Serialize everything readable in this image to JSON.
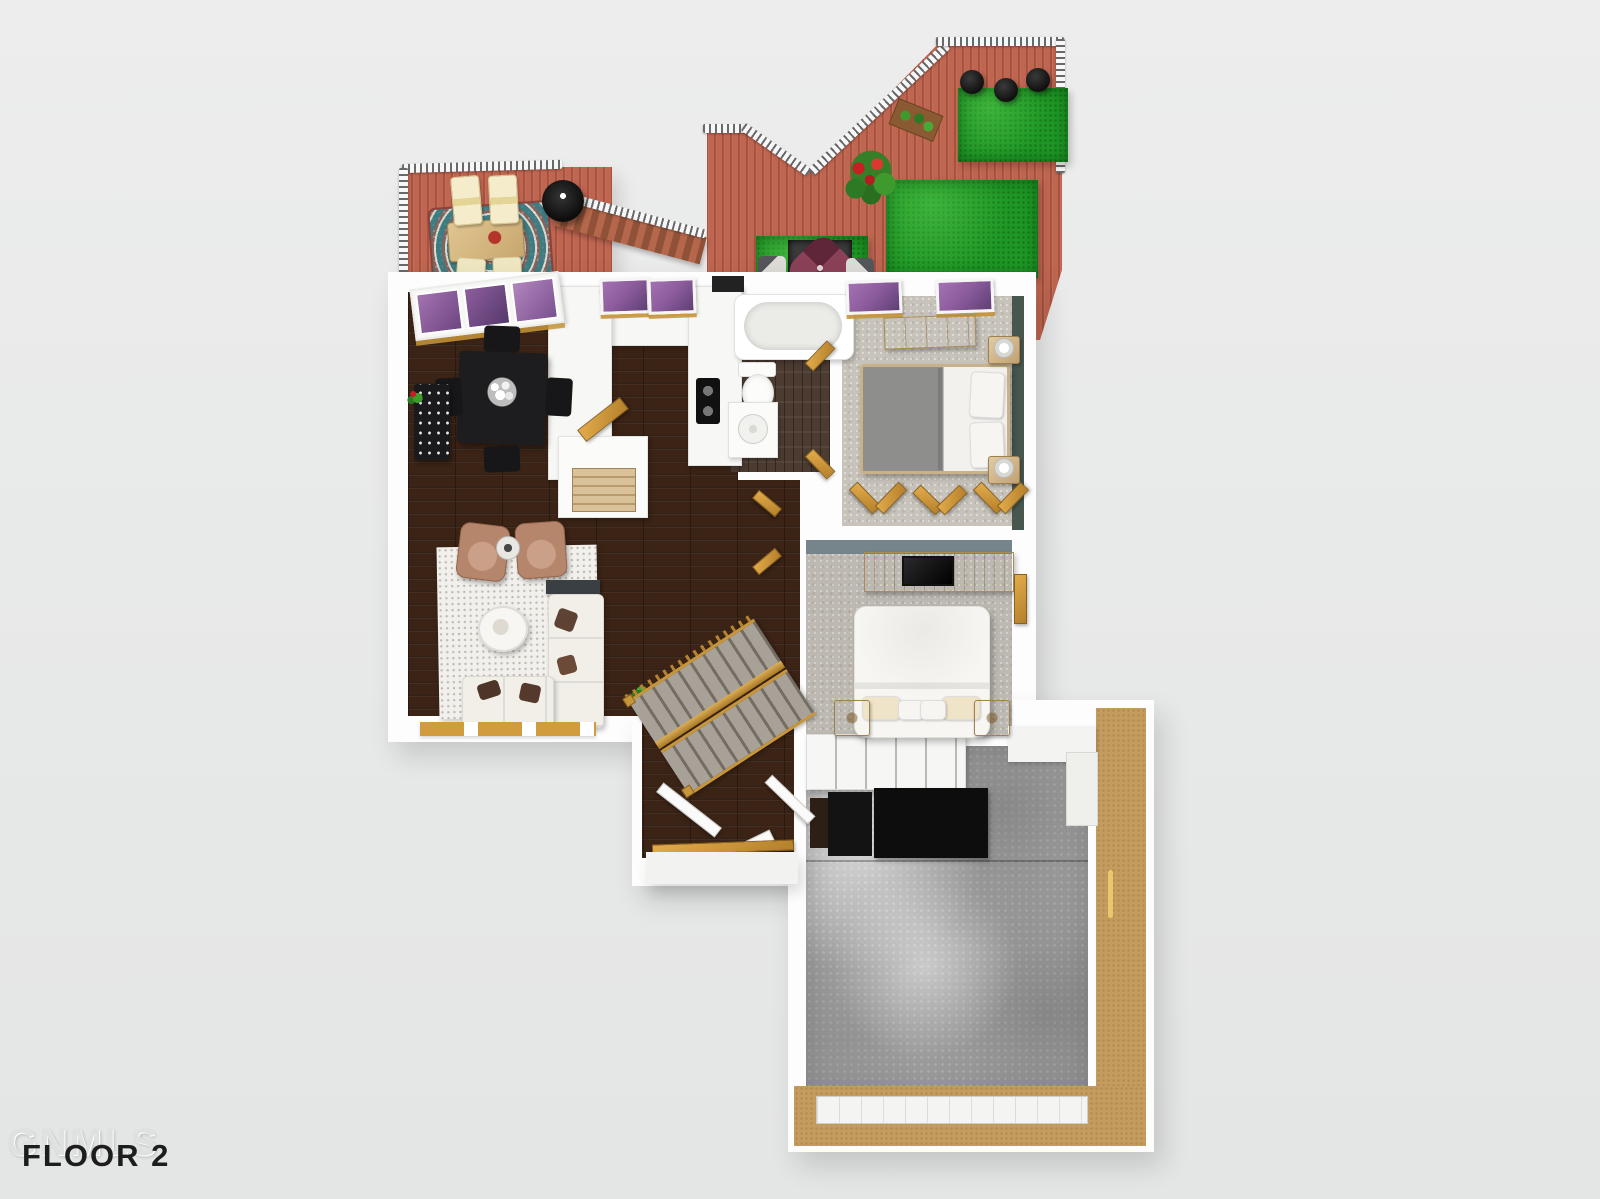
{
  "watermark": {
    "brand": "GNMLS",
    "floor_label": "FLOOR 2"
  },
  "palette": {
    "background": "#ecedec",
    "deck_wood": "#bf6550",
    "deck_stripe": "#a5523f",
    "railing_white": "#f7f7f7",
    "turf_green": "#1f9726",
    "interior_wood": "#3b2315",
    "wall_white": "#fdfdfd",
    "counter_white": "#f7f7f5",
    "carpet_gray": "#c7c3bb",
    "concrete_gray": "#a3a3a3",
    "oak_door": "#d09c3e",
    "accent_teal": "#47564f",
    "accent_blue_gray": "#76858c",
    "garage_tan": "#c59c5f",
    "furniture_black": "#1b1b1d",
    "window_violet": "#8e5d9e"
  },
  "scene": {
    "type": "3d-floor-plan-render",
    "areas": [
      "deck",
      "dining-area",
      "kitchen",
      "bathroom",
      "bedroom-1",
      "hallway",
      "bedroom-2",
      "living-room",
      "stairs",
      "entry",
      "garage"
    ]
  }
}
